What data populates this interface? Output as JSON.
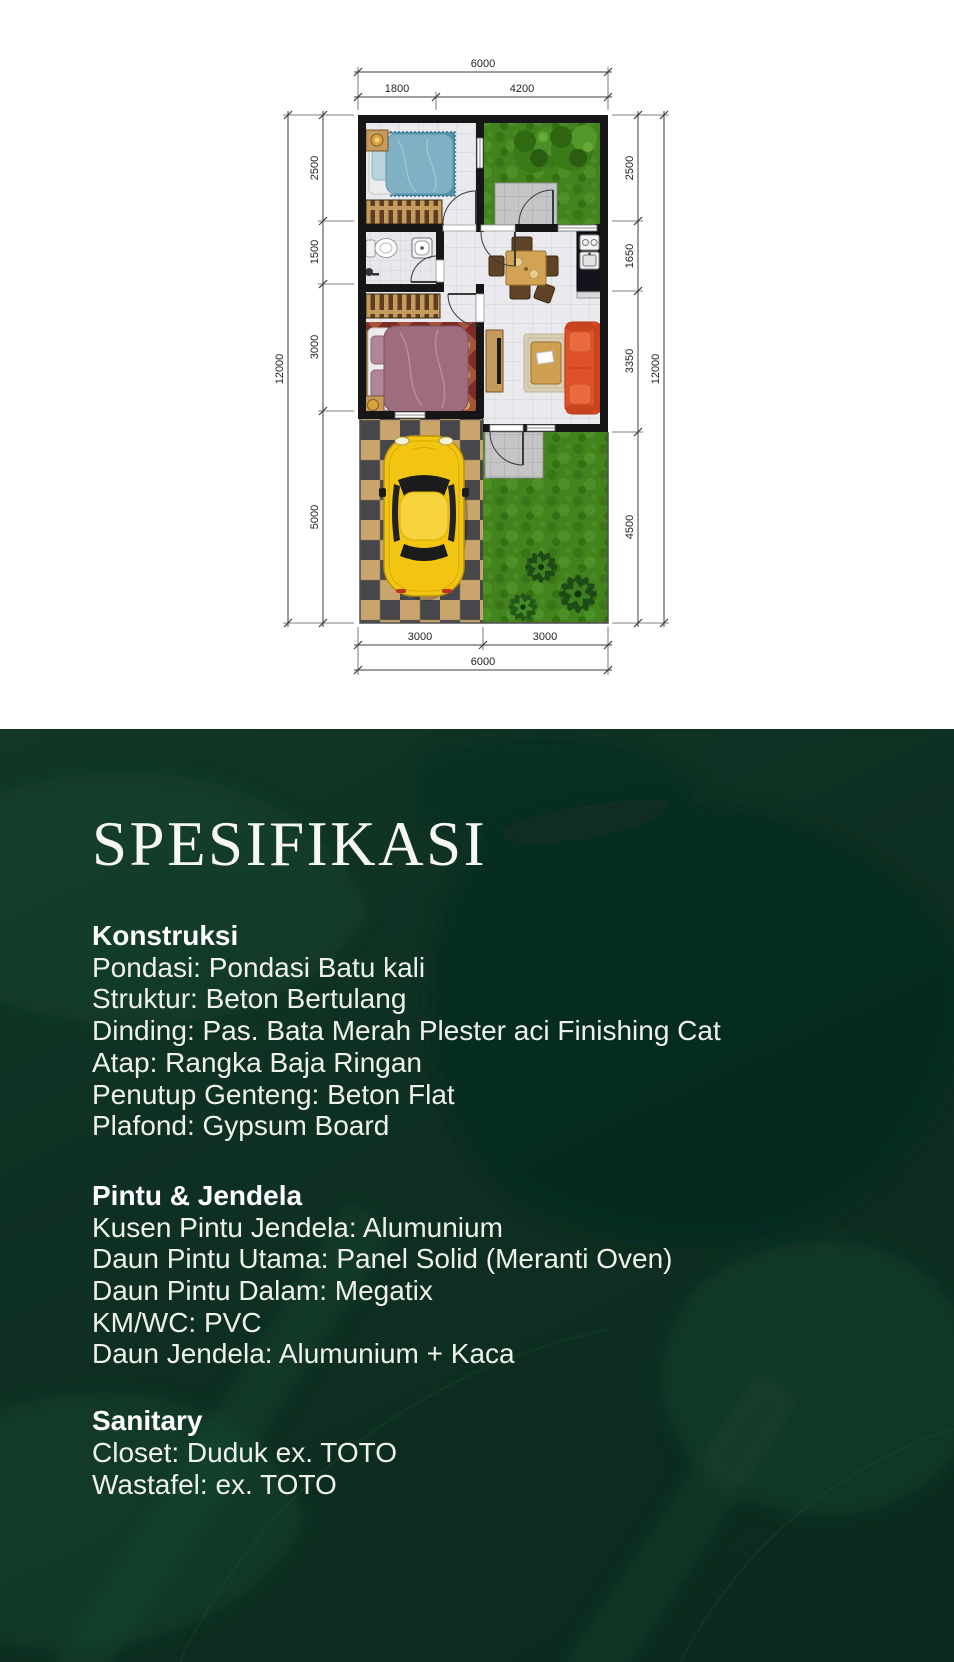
{
  "plan": {
    "dims": {
      "top_total": "6000",
      "top_left": "1800",
      "top_right": "4200",
      "left_outer": "12000",
      "left_segments": [
        "2500",
        "1500",
        "3000",
        "5000"
      ],
      "right_segments": [
        "2500",
        "1650",
        "3350",
        "4500"
      ],
      "right_outer": "12000",
      "bottom_left": "3000",
      "bottom_right": "3000",
      "bottom_total": "6000"
    }
  },
  "spec": {
    "title": "SPESIFIKASI",
    "sections": [
      {
        "heading": "Konstruksi",
        "lines": [
          "Pondasi: Pondasi Batu kali",
          "Struktur: Beton Bertulang",
          "Dinding: Pas. Bata Merah Plester aci Finishing Cat",
          "Atap: Rangka Baja Ringan",
          "Penutup Genteng: Beton Flat",
          "Plafond: Gypsum Board"
        ]
      },
      {
        "heading": "Pintu & Jendela",
        "lines": [
          "Kusen Pintu Jendela: Alumunium",
          "Daun Pintu Utama: Panel Solid (Meranti Oven)",
          "Daun Pintu Dalam: Megatix",
          "KM/WC: PVC",
          "Daun Jendela: Alumunium + Kaca"
        ]
      },
      {
        "heading": "Sanitary",
        "lines": [
          "Closet: Duduk ex. TOTO",
          "Wastafel: ex. TOTO"
        ]
      }
    ]
  },
  "colors": {
    "background_green": "#0e2f22",
    "heading_text": "#ffffff",
    "body_text": "#eef1ec",
    "wall": "#161616",
    "grass": "#43831e",
    "car_yellow": "#f3c513",
    "sofa_orange": "#df5129",
    "bed1_blue": "#7fb0c4",
    "bed2_mauve": "#9d6d7e",
    "wood": "#c59a5e"
  }
}
